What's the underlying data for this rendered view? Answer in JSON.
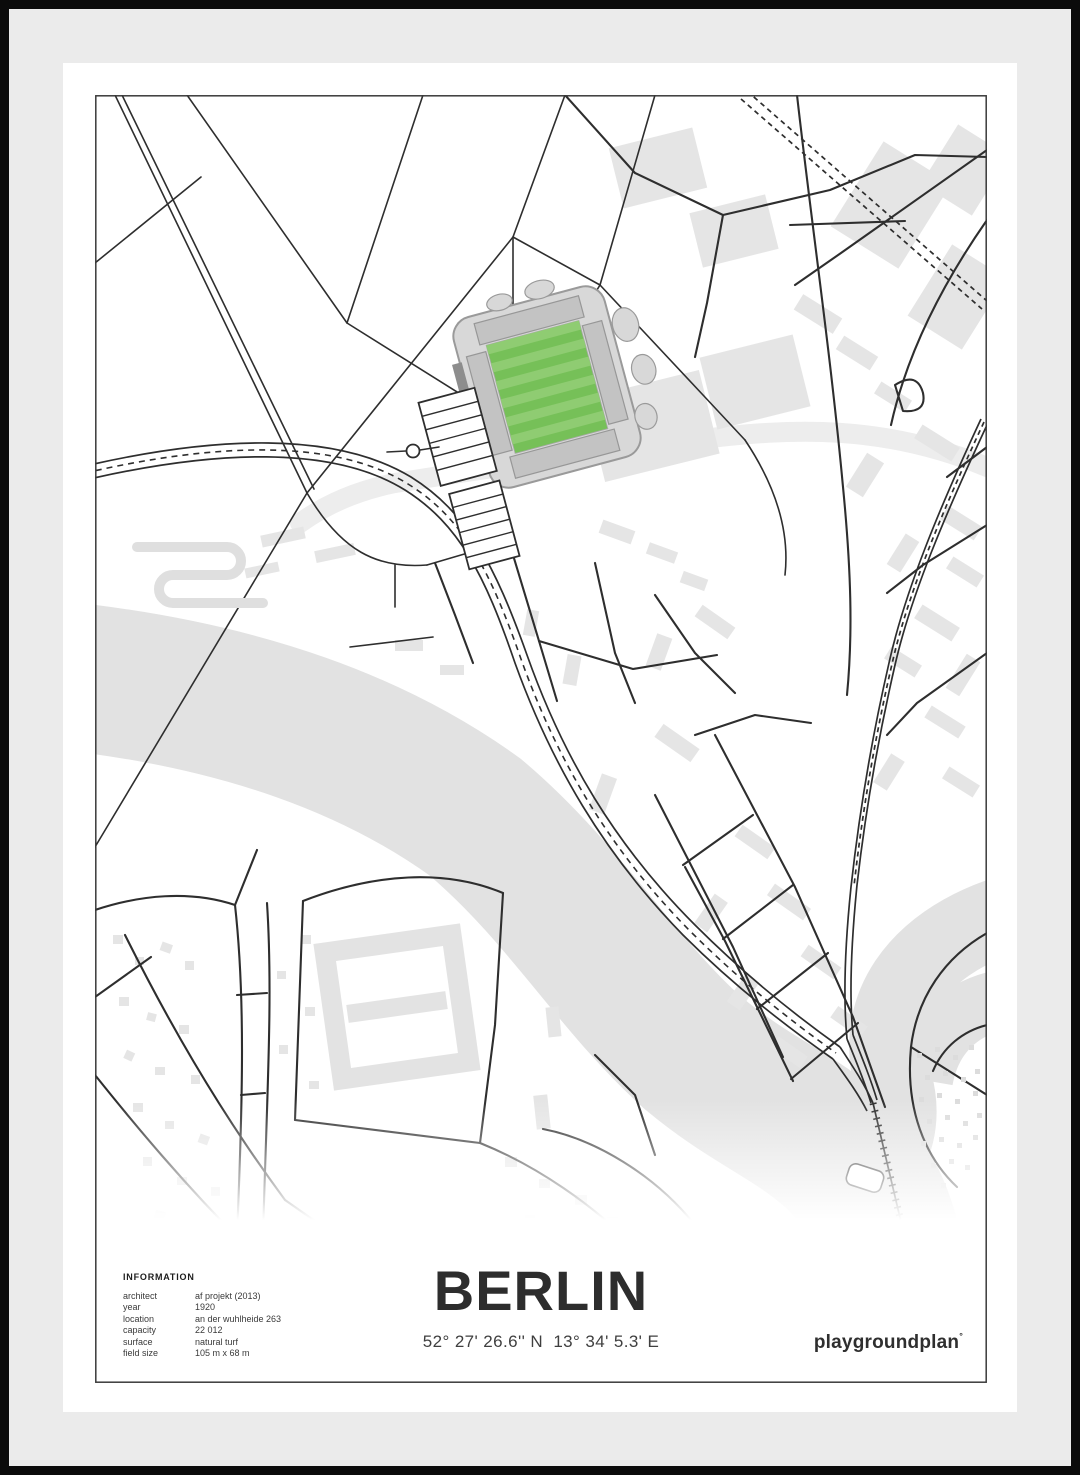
{
  "poster": {
    "info": {
      "heading": "INFORMATION",
      "rows": [
        {
          "label": "architect",
          "value": "af projekt (2013)"
        },
        {
          "label": "year",
          "value": "1920"
        },
        {
          "label": "location",
          "value": "an der wuhlheide 263"
        },
        {
          "label": "capacity",
          "value": "22 012"
        },
        {
          "label": "surface",
          "value": "natural turf"
        },
        {
          "label": "field size",
          "value": "105 m x 68 m"
        }
      ]
    },
    "title": "BERLIN",
    "coordinates": "52° 27' 26.6'' N  13° 34' 5.3' E",
    "brand": {
      "name": "playgroundplan",
      "mark": "°"
    }
  },
  "colors": {
    "pitch": "#76c058",
    "pitch_stripe": "#8fcc72",
    "water": "#e2e2e2",
    "building": "#e5e5e5",
    "map_line": "#2e2e2e",
    "mat": "#ebebeb",
    "frame": "#0b0b0b"
  }
}
